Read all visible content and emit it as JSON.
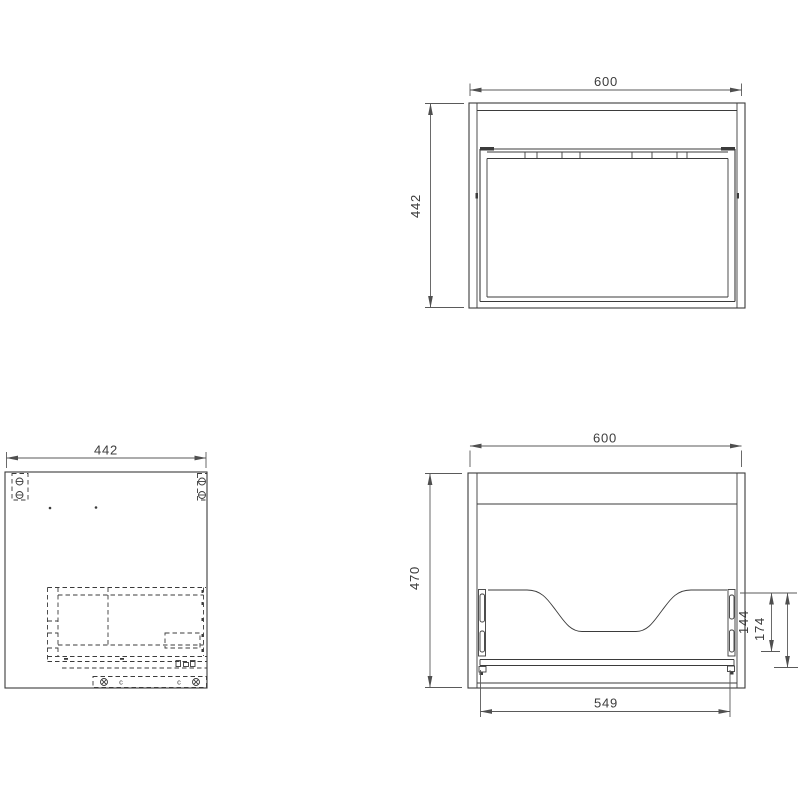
{
  "drawing": {
    "description": "Vanity cabinet technical drawing with three orthographic views",
    "colors": {
      "line": "#3b3b3b",
      "dimension": "#5a5a5a",
      "text": "#3c3c3c",
      "background": "#ffffff"
    },
    "views": {
      "front": {
        "width": "600",
        "height": "442"
      },
      "side": {
        "depth": "442"
      },
      "back": {
        "width": "600",
        "height": "470",
        "bottom_span": "549",
        "slide_length": "144",
        "slide_offset": "174"
      }
    },
    "plan_symbols": {
      "clip_left": "c",
      "clip_right": "c"
    }
  }
}
